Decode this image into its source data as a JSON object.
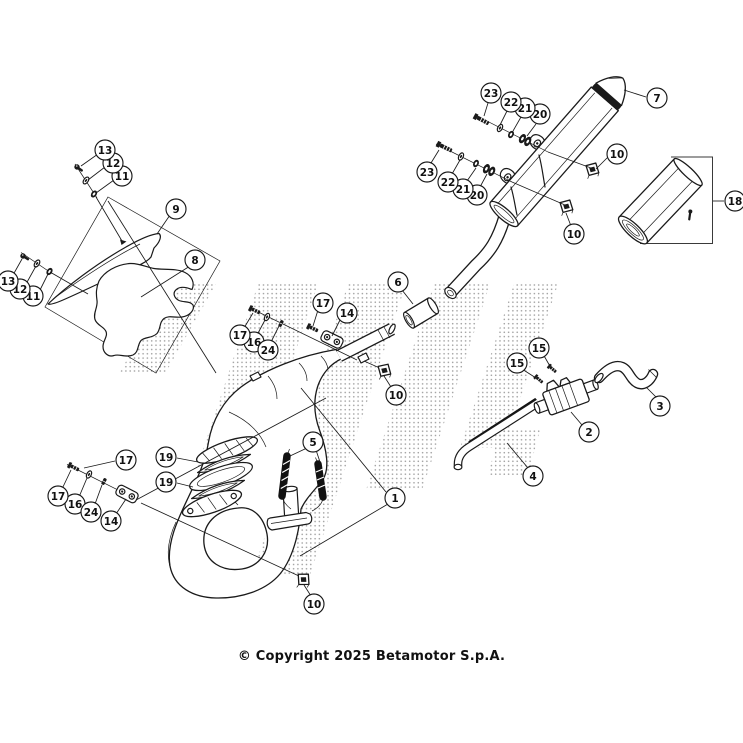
{
  "colors": {
    "line": "#1a1a1a",
    "watermark_dots": "#a0a0a0",
    "background": "#ffffff"
  },
  "footer": {
    "copyright": "© Copyright 2025 Betamotor S.p.A."
  },
  "diagram": {
    "callouts": [
      {
        "label": "1",
        "x": 395,
        "y": 498
      },
      {
        "label": "2",
        "x": 589,
        "y": 432
      },
      {
        "label": "3",
        "x": 660,
        "y": 406
      },
      {
        "label": "4",
        "x": 533,
        "y": 476
      },
      {
        "label": "5",
        "x": 313,
        "y": 442
      },
      {
        "label": "6",
        "x": 398,
        "y": 282
      },
      {
        "label": "7",
        "x": 657,
        "y": 98
      },
      {
        "label": "8",
        "x": 195,
        "y": 260
      },
      {
        "label": "9",
        "x": 176,
        "y": 209
      },
      {
        "label": "10",
        "x": 617,
        "y": 154
      },
      {
        "label": "10",
        "x": 574,
        "y": 234
      },
      {
        "label": "10",
        "x": 396,
        "y": 395
      },
      {
        "label": "10",
        "x": 314,
        "y": 604
      },
      {
        "label": "11",
        "x": 122,
        "y": 176
      },
      {
        "label": "11",
        "x": 33,
        "y": 296
      },
      {
        "label": "12",
        "x": 113,
        "y": 163
      },
      {
        "label": "12",
        "x": 20,
        "y": 289
      },
      {
        "label": "13",
        "x": 105,
        "y": 150
      },
      {
        "label": "13",
        "x": 8,
        "y": 281
      },
      {
        "label": "14",
        "x": 347,
        "y": 313
      },
      {
        "label": "14",
        "x": 111,
        "y": 521
      },
      {
        "label": "15",
        "x": 539,
        "y": 348
      },
      {
        "label": "15",
        "x": 517,
        "y": 363
      },
      {
        "label": "16",
        "x": 254,
        "y": 342
      },
      {
        "label": "16",
        "x": 75,
        "y": 504
      },
      {
        "label": "17",
        "x": 323,
        "y": 303
      },
      {
        "label": "17",
        "x": 240,
        "y": 335
      },
      {
        "label": "17",
        "x": 126,
        "y": 460
      },
      {
        "label": "17",
        "x": 58,
        "y": 496
      },
      {
        "label": "18",
        "x": 735,
        "y": 201
      },
      {
        "label": "19",
        "x": 166,
        "y": 457
      },
      {
        "label": "19",
        "x": 166,
        "y": 482
      },
      {
        "label": "20",
        "x": 540,
        "y": 114
      },
      {
        "label": "20",
        "x": 477,
        "y": 195
      },
      {
        "label": "21",
        "x": 525,
        "y": 108
      },
      {
        "label": "21",
        "x": 463,
        "y": 189
      },
      {
        "label": "22",
        "x": 511,
        "y": 102
      },
      {
        "label": "22",
        "x": 448,
        "y": 182
      },
      {
        "label": "23",
        "x": 491,
        "y": 93
      },
      {
        "label": "23",
        "x": 427,
        "y": 172
      },
      {
        "label": "24",
        "x": 268,
        "y": 350
      },
      {
        "label": "24",
        "x": 91,
        "y": 512
      }
    ]
  }
}
